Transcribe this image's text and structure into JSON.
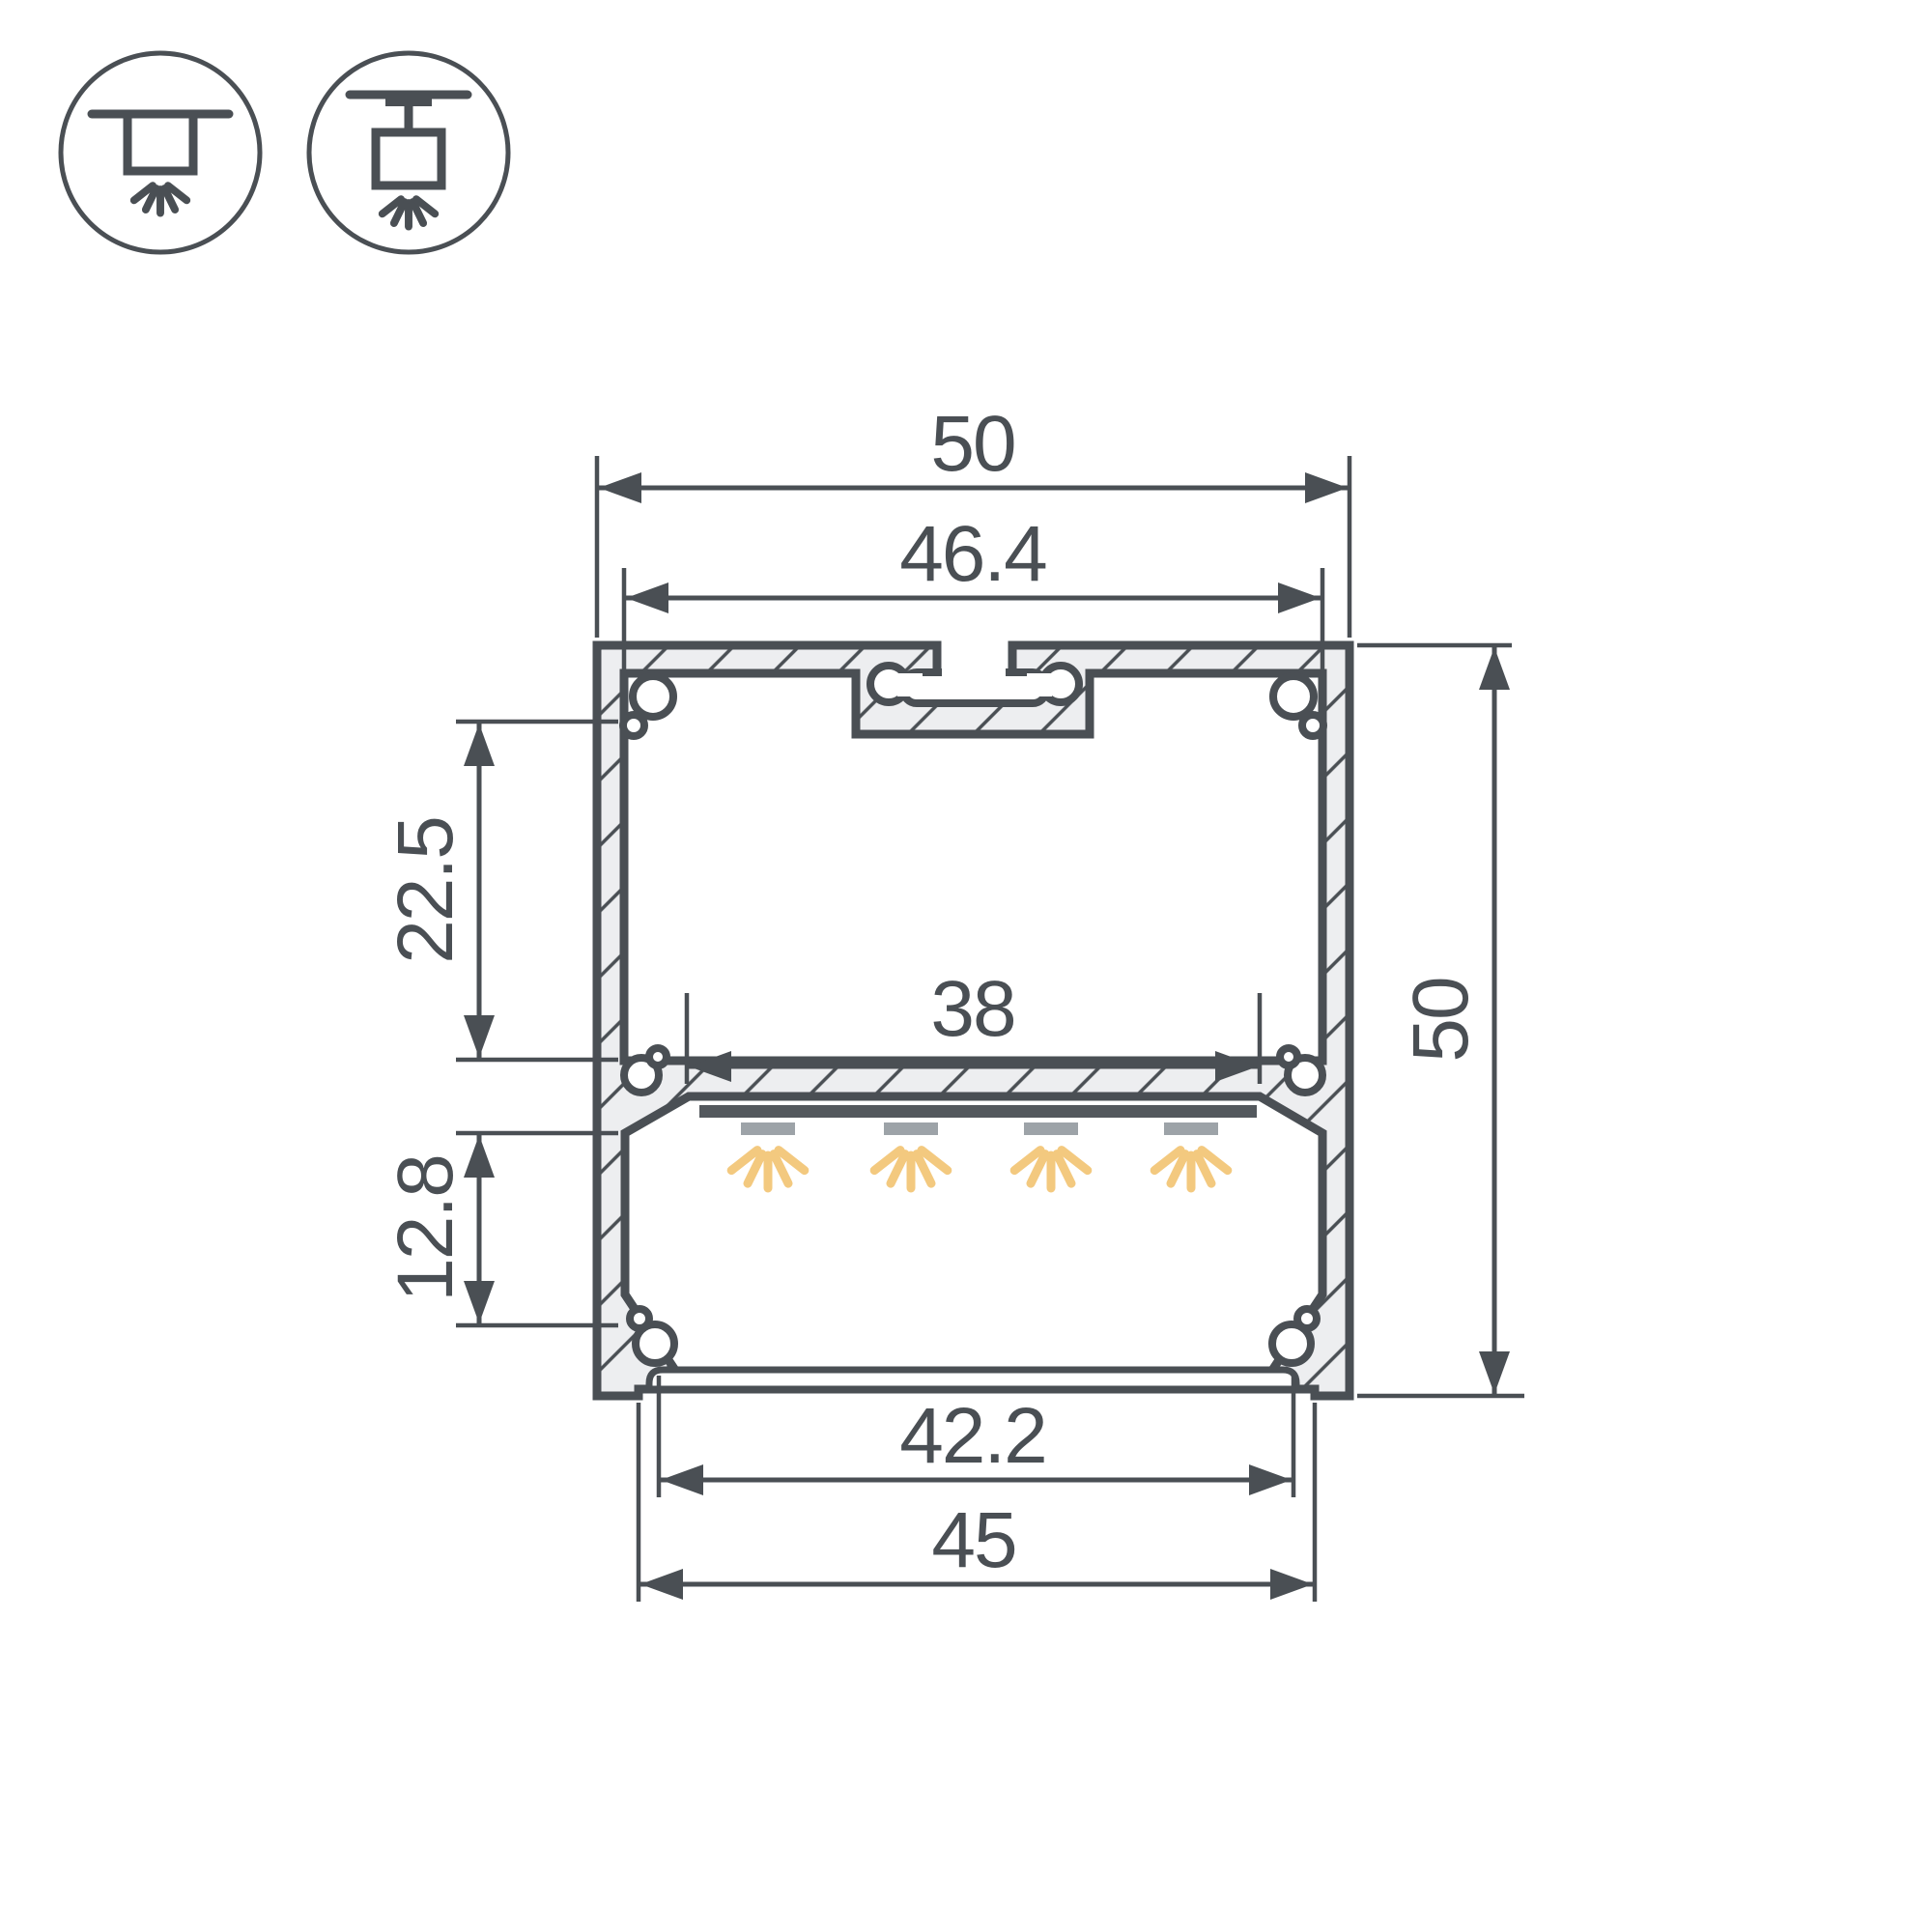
{
  "drawing": {
    "title": "LED aluminium profile cross-section technical drawing",
    "mount_icons": [
      {
        "name": "surface-ceiling-mount-icon",
        "meaning": "surface mounted under ceiling, light directed down"
      },
      {
        "name": "pendant-ceiling-mount-icon",
        "meaning": "suspended from ceiling, light directed down"
      }
    ],
    "dimensions": {
      "outer_width": "50",
      "top_inner_width": "46.4",
      "led_platform_width": "38",
      "upper_chamber_height": "22.5",
      "lower_chamber_height": "12.8",
      "outer_height": "50",
      "diffuser_width": "42.2",
      "bottom_width": "45"
    },
    "features": {
      "led_count": 4,
      "hatching": "diagonal 45deg section hatching",
      "parts": [
        "top suspension T-slot",
        "screw ports in corners",
        "LED platform shelf",
        "LED strip",
        "bottom diffuser cover"
      ]
    },
    "colors": {
      "line": "#4a4f54",
      "hatch_fill": "#edeef0",
      "led_bar": "#53585d",
      "led_module": "#9da3a8",
      "light_ray": "#f3c97f",
      "background": "#ffffff"
    }
  }
}
